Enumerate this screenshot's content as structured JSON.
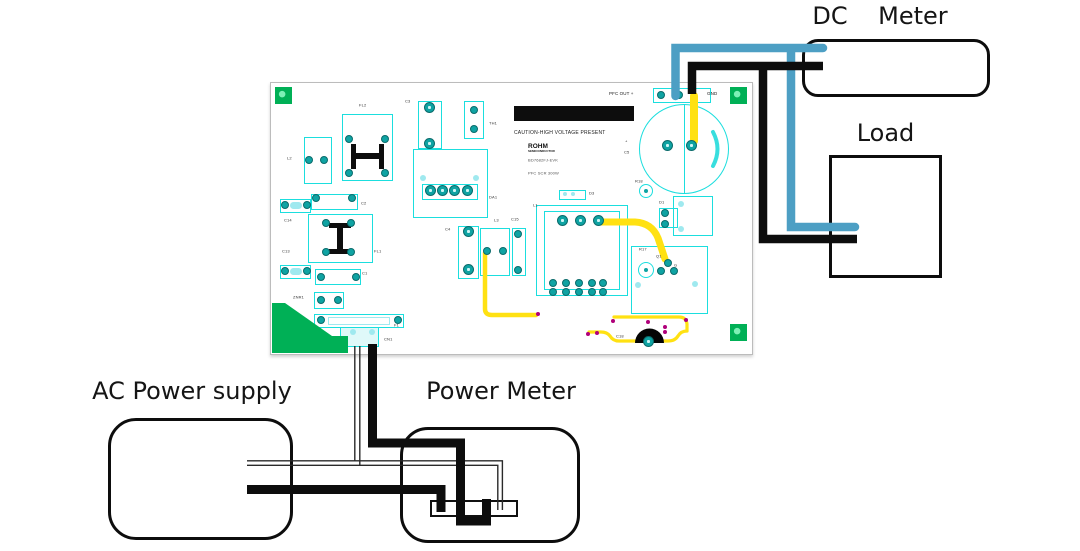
{
  "instruments": {
    "dc_meter": "DC    Meter",
    "load": "Load",
    "ac_power_supply": "AC Power supply",
    "power_meter": "Power Meter"
  },
  "pcb": {
    "caution": "CAUTION-HIGH VOLTAGE PRESENT",
    "brand": "ROHM",
    "brand_sub": "SEMICONDUCTOR",
    "board_line1": "BD7682FJ-EVK",
    "board_line2": "PFC SCR 300W",
    "terminals": {
      "positive": "PFC OUT +",
      "negative": "GND"
    },
    "refs": {
      "L2": "L2",
      "FL2": "FL2",
      "C3": "C3",
      "TH1": "TH1",
      "C2": "C2",
      "C14": "C14",
      "C13": "C13",
      "FL1": "FL1",
      "C1": "C1",
      "ZNR1": "ZNR1",
      "F1": "F1",
      "CN1": "CN1",
      "DA1": "DA1",
      "D3": "D3",
      "C4": "C4",
      "L3": "L3",
      "C15": "C15",
      "L1": "L1",
      "D1": "D1",
      "R18": "R18",
      "C5": "C5",
      "C5_polarity": "+",
      "R17": "R17",
      "Q1": "Q1",
      "G": "G",
      "C18": "C18"
    }
  },
  "colors": {
    "wire_dc_blue": "#4d9fc4",
    "wire_black": "#0d0d0d",
    "pcb_outline_cyan": "#1bdede",
    "pad_teal": "#0fa3a3",
    "pad_green": "#00b056",
    "trace_yellow": "#ffe112",
    "via_magenta": "#b0007a"
  }
}
